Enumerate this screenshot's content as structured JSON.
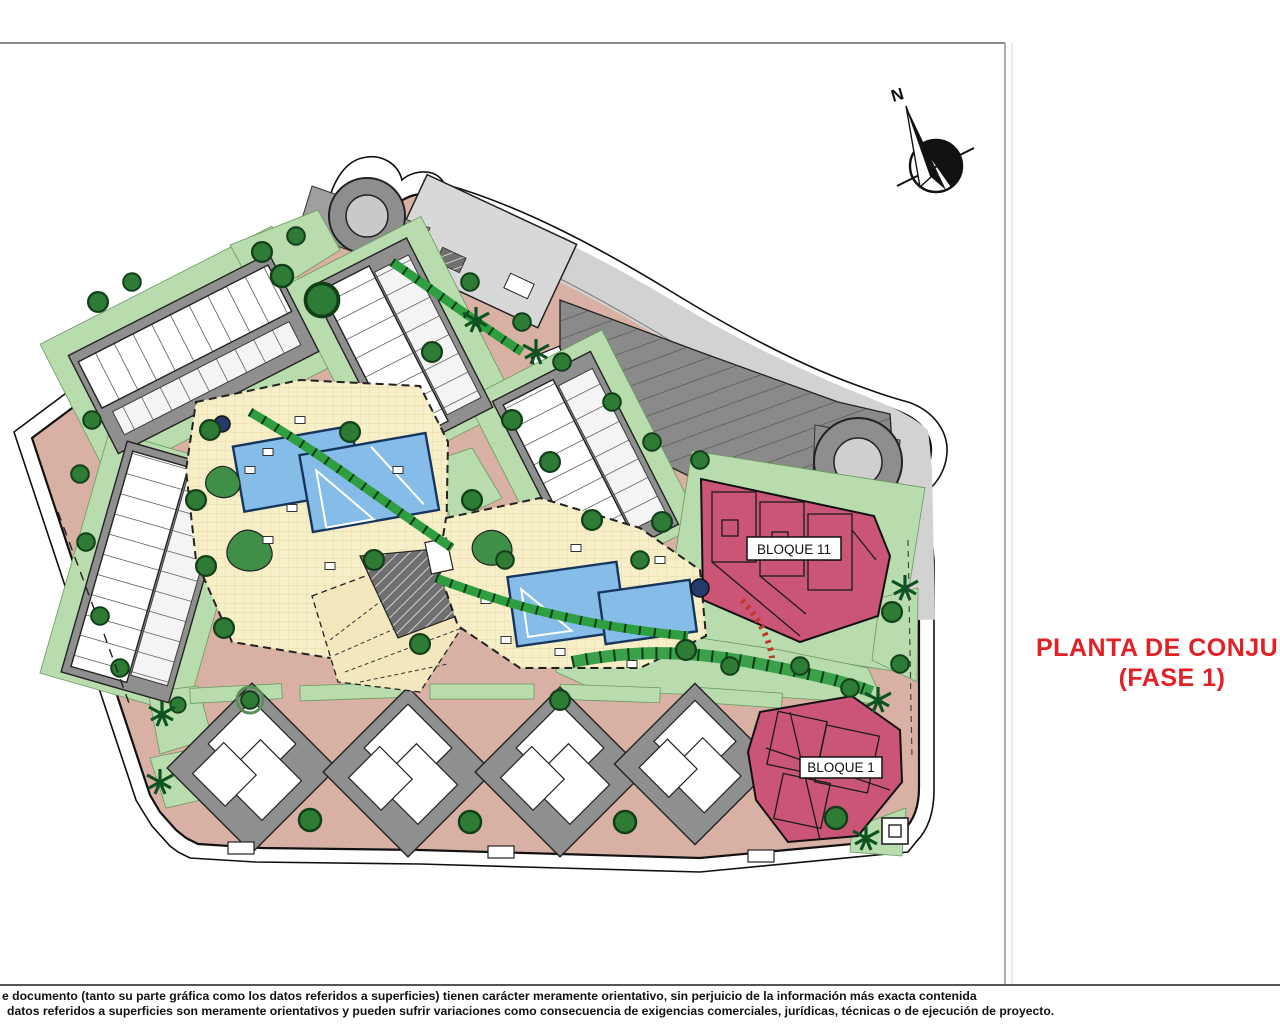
{
  "drawing": {
    "title": {
      "line1": "PLANTA DE CONJUNTO",
      "line2": "(FASE 1)"
    },
    "compass": {
      "north_label": "N"
    },
    "blocks": {
      "bloque11_label": "BLOQUE 11",
      "bloque1_label": "BLOQUE 1"
    },
    "disclaimer": {
      "line1": "e documento (tanto su parte gráfica como los datos referidos a superficies) tienen carácter meramente orientativo, sin perjuicio de la información más exacta contenida",
      "line2": "datos referidos a superficies son meramente orientativos y pueden sufrir variaciones como consecuencia de exigencias comerciales, jurídicas, técnicas o de ejecución de proyecto."
    },
    "colors": {
      "title_red": "#e02125",
      "block_pink": "#cb5577",
      "road_pink": "#d8b1a4",
      "deck_yellow": "#f7efc7",
      "pool_blue": "#85bce8",
      "lawn_green": "#b9dcae",
      "hedge_green": "#2f9e41",
      "tree_green": "#2e7b36",
      "parking_gray": "#8a8a8a",
      "light_road_gray": "#d2d2d2"
    }
  }
}
